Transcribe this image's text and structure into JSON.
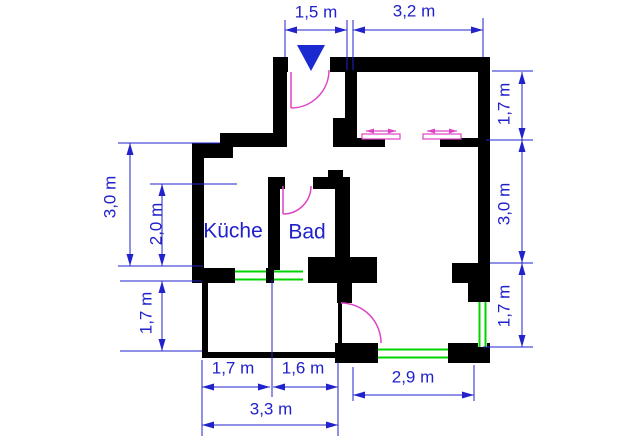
{
  "labels": {
    "top_1": "1,5 m",
    "top_2": "3,2 m",
    "right_1": "1,7 m",
    "right_2": "3,0 m",
    "right_3": "1,7 m",
    "left_1": "3,0 m",
    "left_2": "2,0 m",
    "left_3": "1,7 m",
    "bottom_1": "1,7 m",
    "bottom_2": "1,6 m",
    "bottom_3": "3,3 m",
    "bottom_4": "2,9 m",
    "room_kitchen": "Küche",
    "room_bath": "Bad"
  },
  "colors": {
    "wall": "#000000",
    "dimension": "#2222cc",
    "door": "#dd44c4",
    "window": "#00d400",
    "entrance_marker": "#1a2ad0",
    "background": "#ffffff"
  },
  "plan": {
    "walls": [
      [
        273,
        57,
        15,
        15
      ],
      [
        330,
        57,
        160,
        15
      ],
      [
        273,
        57,
        14,
        86
      ],
      [
        220,
        133,
        67,
        14
      ],
      [
        192,
        143,
        41,
        15
      ],
      [
        192,
        143,
        12,
        140
      ],
      [
        192,
        268,
        43,
        15
      ],
      [
        266,
        268,
        8,
        15
      ],
      [
        308,
        257,
        69,
        26
      ],
      [
        345,
        57,
        12,
        90
      ],
      [
        333,
        118,
        24,
        29
      ],
      [
        348,
        138,
        37,
        9
      ],
      [
        440,
        138,
        43,
        9
      ],
      [
        268,
        177,
        12,
        93
      ],
      [
        268,
        177,
        17,
        12
      ],
      [
        313,
        177,
        22,
        12
      ],
      [
        328,
        170,
        15,
        19
      ],
      [
        335,
        177,
        15,
        93
      ],
      [
        337,
        275,
        15,
        28
      ],
      [
        478,
        57,
        12,
        245
      ],
      [
        452,
        263,
        26,
        20
      ],
      [
        468,
        263,
        10,
        39
      ],
      [
        448,
        343,
        42,
        20
      ],
      [
        335,
        343,
        43,
        20
      ],
      [
        338,
        303,
        4,
        40
      ]
    ],
    "balcony_walls": [
      [
        202,
        283,
        6,
        75
      ],
      [
        202,
        352,
        138,
        6
      ]
    ],
    "windows": [
      {
        "x": 235,
        "y": 270,
        "w": 31,
        "h": 11,
        "o": "h"
      },
      {
        "x": 274,
        "y": 270,
        "w": 29,
        "h": 11,
        "o": "h"
      },
      {
        "x": 378,
        "y": 348,
        "w": 70,
        "h": 11,
        "o": "h"
      },
      {
        "x": 478,
        "y": 302,
        "w": 9,
        "h": 45,
        "o": "v"
      }
    ],
    "doors": [
      {
        "leaf": [
          291,
          72,
          291,
          108
        ],
        "arc": {
          "sx": 291,
          "sy": 108,
          "r": 38,
          "ex": 329,
          "ey": 70,
          "sweep": 0
        }
      },
      {
        "leaf": [
          283,
          186,
          283,
          214
        ],
        "arc": {
          "sx": 283,
          "sy": 214,
          "r": 28,
          "ex": 311,
          "ey": 186,
          "sweep": 0
        }
      },
      {
        "leaf": null,
        "arc": {
          "sx": 341,
          "sy": 303,
          "r": 40,
          "ex": 381,
          "ey": 343,
          "sweep": 1
        }
      }
    ],
    "sliding_doors": [
      {
        "panel": [
          362,
          134,
          38,
          5
        ],
        "arrow": [
          366,
          396,
          131
        ]
      },
      {
        "panel": [
          423,
          134,
          38,
          5
        ],
        "arrow": [
          427,
          457,
          131
        ]
      }
    ],
    "entrance_marker": [
      [
        297,
        45
      ],
      [
        325,
        45
      ],
      [
        311,
        71
      ]
    ],
    "dim_lines": [
      {
        "o": "h",
        "x1": 285,
        "x2": 347,
        "y": 30
      },
      {
        "o": "h",
        "x1": 353,
        "x2": 483,
        "y": 30
      },
      {
        "o": "v",
        "x": 522,
        "y1": 72,
        "y2": 140
      },
      {
        "o": "v",
        "x": 522,
        "y1": 140,
        "y2": 263
      },
      {
        "o": "v",
        "x": 522,
        "y1": 263,
        "y2": 347
      },
      {
        "o": "v",
        "x": 130,
        "y1": 143,
        "y2": 266
      },
      {
        "o": "v",
        "x": 162,
        "y1": 184,
        "y2": 266
      },
      {
        "o": "v",
        "x": 162,
        "y1": 281,
        "y2": 351
      },
      {
        "o": "h",
        "x1": 202,
        "x2": 270,
        "y": 387
      },
      {
        "o": "h",
        "x1": 273,
        "x2": 338,
        "y": 387
      },
      {
        "o": "h",
        "x1": 202,
        "x2": 338,
        "y": 425
      },
      {
        "o": "h",
        "x1": 353,
        "x2": 474,
        "y": 395
      }
    ],
    "ext_lines": [
      [
        285,
        20,
        285,
        57
      ],
      [
        347,
        20,
        347,
        70
      ],
      [
        353,
        20,
        353,
        70
      ],
      [
        483,
        18,
        483,
        57
      ],
      [
        492,
        71,
        533,
        71
      ],
      [
        486,
        140,
        533,
        140
      ],
      [
        490,
        263,
        533,
        263
      ],
      [
        483,
        347,
        533,
        347
      ],
      [
        118,
        143,
        220,
        143
      ],
      [
        150,
        184,
        237,
        184
      ],
      [
        118,
        266,
        203,
        266
      ],
      [
        120,
        281,
        202,
        281
      ],
      [
        120,
        351,
        202,
        351
      ],
      [
        202,
        360,
        202,
        436
      ],
      [
        272,
        280,
        272,
        397
      ],
      [
        338,
        362,
        338,
        436
      ],
      [
        353,
        367,
        353,
        401
      ],
      [
        474,
        365,
        474,
        401
      ]
    ]
  }
}
